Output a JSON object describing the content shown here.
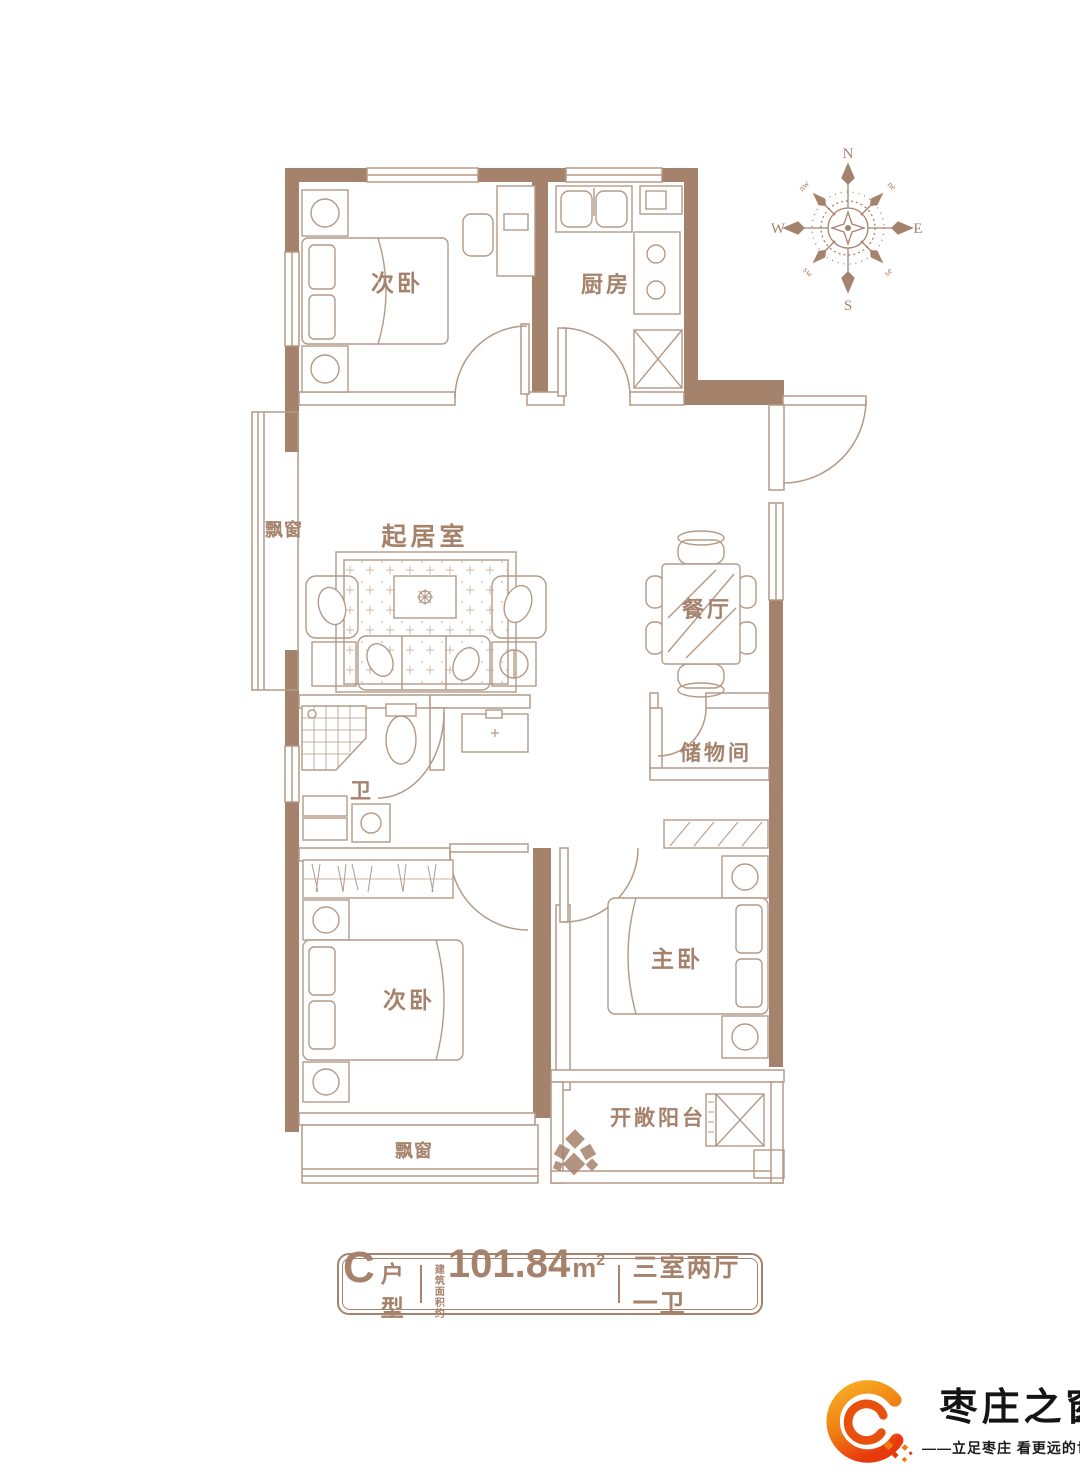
{
  "plan": {
    "rooms": [
      {
        "id": "bedroom-top",
        "label": "次卧"
      },
      {
        "id": "kitchen",
        "label": "厨房"
      },
      {
        "id": "bay-window-left",
        "label": "飘窗"
      },
      {
        "id": "living-room",
        "label": "起居室"
      },
      {
        "id": "dining-room",
        "label": "餐厅"
      },
      {
        "id": "storage-room",
        "label": "储物间"
      },
      {
        "id": "bathroom",
        "label": "卫"
      },
      {
        "id": "bedroom-bottom",
        "label": "次卧"
      },
      {
        "id": "master-bedroom",
        "label": "主卧"
      },
      {
        "id": "bay-window-bottom",
        "label": "飘窗"
      },
      {
        "id": "balcony",
        "label": "开敞阳台"
      }
    ],
    "compass": {
      "n": "N",
      "e": "E",
      "s": "S",
      "w": "W",
      "ne": "ne",
      "nw": "nw",
      "se": "se",
      "sw": "sw"
    }
  },
  "info_bar": {
    "type_letter": "C",
    "type_suffix": "户型",
    "area_prefix_line1": "建筑",
    "area_prefix_line2": "面积约",
    "area_value": "101.84",
    "area_unit": "m",
    "area_sup": "2",
    "layout": "三室两厅一卫"
  },
  "logo": {
    "name": "枣庄之窗",
    "tagline": "——立足枣庄 看更远的世界——"
  },
  "colors": {
    "wall": "#a5826b",
    "line": "#b39a87",
    "label_text": "#a5826b",
    "logo_orange": "#f08300",
    "logo_red": "#e94709",
    "seal_red": "#d9262c"
  }
}
